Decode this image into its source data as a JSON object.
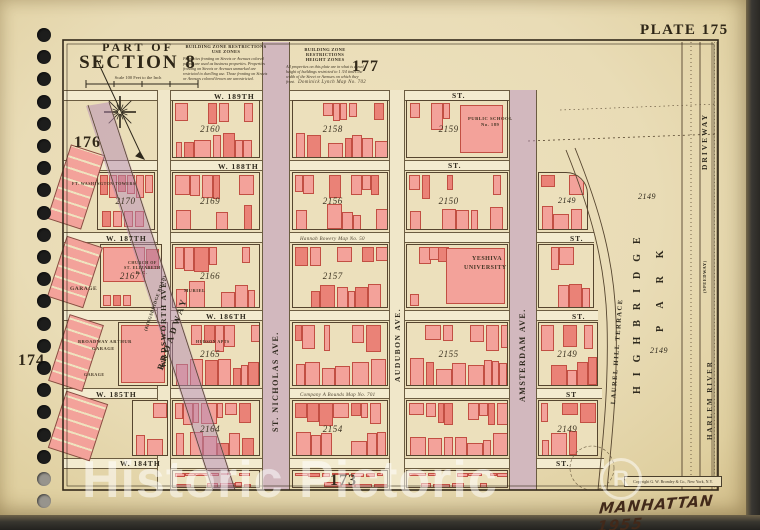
{
  "page": {
    "plate_label": "PLATE 175",
    "part_of": "PART OF",
    "section": "SECTION 8",
    "scale_note": "Scale 100 Feet to the Inch",
    "handwritten_note": "MANHATTAN 1955",
    "watermark_text": "Historic Pictoric",
    "watermark_mark": "R",
    "copyright": "Copyright G. W. Bromley & Co., New York, N.Y.",
    "adjacent_plates": {
      "top": "177",
      "upper_left": "176",
      "left": "174",
      "bottom": "173"
    }
  },
  "zone_restrictions": {
    "use": {
      "heading": "BUILDING ZONE RESTRICTIONS",
      "subheading": "USE ZONES",
      "body": "Properties fronting on Streets or Avenues colored purple are used as business properties. Properties fronting on Streets or Avenues unmarked are restricted to dwelling use. Those fronting on Streets or Avenues colored brown are unrestricted."
    },
    "height": {
      "heading": "BUILDING ZONE RESTRICTIONS",
      "subheading": "HEIGHT ZONES",
      "body": "All properties on this plate are in what is zoned height of buildings restricted to 1 3/4 times the width of the Street or Avenues on which they front."
    }
  },
  "colors": {
    "page": "#e9dcb6",
    "building": "#f3a29a",
    "building_outline": "#c24f43",
    "zone_purple": "#b48ab4",
    "line": "#56452f",
    "hole_dark": "#1d1d1c",
    "hole_light": "#97948d"
  },
  "map": {
    "street_labels": [
      {
        "t": "W. 189TH",
        "x": 214,
        "y": 92
      },
      {
        "t": "ST.",
        "x": 452,
        "y": 91
      },
      {
        "t": "W. 188TH",
        "x": 218,
        "y": 162
      },
      {
        "t": "ST.",
        "x": 448,
        "y": 161
      },
      {
        "t": "W. 187TH",
        "x": 106,
        "y": 234
      },
      {
        "t": "ST.",
        "x": 570,
        "y": 234
      },
      {
        "t": "W. 186TH",
        "x": 206,
        "y": 312
      },
      {
        "t": "ST.",
        "x": 572,
        "y": 312
      },
      {
        "t": "W. 185TH",
        "x": 96,
        "y": 390
      },
      {
        "t": "ST",
        "x": 566,
        "y": 390
      },
      {
        "t": "W. 184TH",
        "x": 120,
        "y": 459
      },
      {
        "t": "ST.",
        "x": 556,
        "y": 459
      }
    ],
    "avenue_labels": [
      {
        "t": "BROADWAY",
        "x": 155,
        "y": 368,
        "r": -71,
        "s": 9,
        "ls": 3
      },
      {
        "t": "(KINGSBRIDGE ROAD)",
        "x": 143,
        "y": 330,
        "r": -71,
        "s": 4.5,
        "ls": 0.5
      },
      {
        "t": "WADSWORTH AVE.",
        "x": 159,
        "y": 368,
        "r": -90,
        "s": 7.5,
        "ls": 1.5
      },
      {
        "t": "ST. NICHOLAS AVE.",
        "x": 271,
        "y": 432,
        "r": -90,
        "s": 8,
        "ls": 1.5
      },
      {
        "t": "AUDUBON AVE.",
        "x": 393,
        "y": 382,
        "r": -90,
        "s": 7.5,
        "ls": 1.5
      },
      {
        "t": "AMSTERDAM AVE.",
        "x": 518,
        "y": 402,
        "r": -90,
        "s": 8,
        "ls": 1.5
      },
      {
        "t": "LAUREL HILL TERRACE",
        "x": 610,
        "y": 404,
        "r": -86,
        "s": 6.5,
        "ls": 1.5
      },
      {
        "t": "DRIVEWAY",
        "x": 700,
        "y": 170,
        "r": -90,
        "s": 7.5,
        "ls": 2
      },
      {
        "t": "(SPEEDWAY)",
        "x": 702,
        "y": 293,
        "r": -90,
        "s": 4.5,
        "ls": 0.5
      },
      {
        "t": "HARLEM RIVER",
        "x": 706,
        "y": 440,
        "r": -90,
        "s": 7,
        "ls": 2
      },
      {
        "t": "HIGHBRIDGE",
        "x": 632,
        "y": 394,
        "r": -90,
        "s": 10,
        "ls": 10
      },
      {
        "t": "PARK",
        "x": 655,
        "y": 332,
        "r": -90,
        "s": 10,
        "ls": 18
      }
    ],
    "map_refs": [
      {
        "t": "Dominick Lynch Map No. 702",
        "x": 298,
        "y": 80
      },
      {
        "t": "Hannah Bowery Map No. 50",
        "x": 300,
        "y": 237
      },
      {
        "t": "Company A Bounds Map No. 701",
        "x": 300,
        "y": 393
      }
    ],
    "park_numbers": [
      {
        "t": "2149",
        "x": 638,
        "y": 192
      },
      {
        "t": "2149",
        "x": 650,
        "y": 346
      },
      {
        "t": "2149",
        "x": 558,
        "y": 196
      }
    ],
    "building_labels": [
      {
        "t": "FT. WASHINGTON TOWERS",
        "x": 72,
        "y": 181,
        "s": 4
      },
      {
        "t": "CHURCH OF",
        "x": 128,
        "y": 260,
        "s": 4
      },
      {
        "t": "ST. ELIZABETH",
        "x": 124,
        "y": 265,
        "s": 4
      },
      {
        "t": "R. C.",
        "x": 136,
        "y": 270,
        "s": 4
      },
      {
        "t": "GARAGE",
        "x": 70,
        "y": 286,
        "s": 5.5
      },
      {
        "t": "BROADWAY ARTHUR",
        "x": 78,
        "y": 339,
        "s": 4.5
      },
      {
        "t": "GARAGE",
        "x": 92,
        "y": 346,
        "s": 4.5
      },
      {
        "t": "GARAGE",
        "x": 84,
        "y": 372,
        "s": 4
      },
      {
        "t": "MURIEL",
        "x": 184,
        "y": 288,
        "s": 4.5
      },
      {
        "t": "HUDSON APTS",
        "x": 196,
        "y": 339,
        "s": 4
      },
      {
        "t": "PUBLIC SCHOOL",
        "x": 468,
        "y": 116,
        "s": 4.6
      },
      {
        "t": "No. 189",
        "x": 481,
        "y": 122,
        "s": 4.6
      },
      {
        "t": "YESHIVA",
        "x": 472,
        "y": 256,
        "s": 6
      },
      {
        "t": "UNIVERSITY",
        "x": 464,
        "y": 265,
        "s": 6
      }
    ],
    "blocks": [
      {
        "n": "2160",
        "x": 172,
        "y": 100,
        "w": 88,
        "h": 58
      },
      {
        "n": "2158",
        "x": 292,
        "y": 100,
        "w": 96,
        "h": 58
      },
      {
        "n": "2159",
        "x": 406,
        "y": 100,
        "w": 102,
        "h": 58,
        "s": "school"
      },
      {
        "n": "2170",
        "x": 97,
        "y": 172,
        "w": 58,
        "h": 58,
        "s": "rows"
      },
      {
        "n": "2169",
        "x": 172,
        "y": 172,
        "w": 88,
        "h": 58
      },
      {
        "n": "2156",
        "x": 292,
        "y": 172,
        "w": 96,
        "h": 58
      },
      {
        "n": "2150",
        "x": 406,
        "y": 172,
        "w": 102,
        "h": 58
      },
      {
        "n": "",
        "x": 538,
        "y": 172,
        "w": 50,
        "h": 58,
        "s": "rTR"
      },
      {
        "n": "2167",
        "x": 100,
        "y": 244,
        "w": 62,
        "h": 64,
        "s": "church"
      },
      {
        "n": "2166",
        "x": 172,
        "y": 244,
        "w": 88,
        "h": 64
      },
      {
        "n": "2157",
        "x": 292,
        "y": 244,
        "w": 96,
        "h": 64
      },
      {
        "n": "",
        "x": 406,
        "y": 244,
        "w": 102,
        "h": 64,
        "s": "yeshiva"
      },
      {
        "n": "",
        "x": 538,
        "y": 244,
        "w": 56,
        "h": 64
      },
      {
        "n": "",
        "x": 118,
        "y": 322,
        "w": 50,
        "h": 64,
        "s": "solid"
      },
      {
        "n": "2165",
        "x": 172,
        "y": 322,
        "w": 88,
        "h": 64
      },
      {
        "n": "",
        "x": 292,
        "y": 322,
        "w": 96,
        "h": 64
      },
      {
        "n": "2155",
        "x": 406,
        "y": 322,
        "w": 102,
        "h": 64
      },
      {
        "n": "2149",
        "x": 538,
        "y": 322,
        "w": 60,
        "h": 64
      },
      {
        "n": "",
        "x": 132,
        "y": 400,
        "w": 36,
        "h": 56
      },
      {
        "n": "2164",
        "x": 172,
        "y": 400,
        "w": 88,
        "h": 56
      },
      {
        "n": "2154",
        "x": 292,
        "y": 400,
        "w": 96,
        "h": 56
      },
      {
        "n": "",
        "x": 406,
        "y": 400,
        "w": 102,
        "h": 56
      },
      {
        "n": "2149",
        "x": 538,
        "y": 400,
        "w": 60,
        "h": 56
      },
      {
        "n": "",
        "x": 172,
        "y": 470,
        "w": 88,
        "h": 18
      },
      {
        "n": "",
        "x": 292,
        "y": 470,
        "w": 96,
        "h": 18
      },
      {
        "n": "",
        "x": 406,
        "y": 470,
        "w": 102,
        "h": 18
      }
    ],
    "west_strips": [
      {
        "x": 58,
        "y": 148,
        "w": 34,
        "h": 76,
        "r": 18
      },
      {
        "x": 56,
        "y": 240,
        "w": 36,
        "h": 62,
        "r": 18
      },
      {
        "x": 58,
        "y": 318,
        "w": 34,
        "h": 68,
        "r": 18
      },
      {
        "x": 56,
        "y": 396,
        "w": 42,
        "h": 58,
        "r": 18
      }
    ],
    "street_bands": [
      {
        "x": 64,
        "y": 90,
        "w": 446,
        "h": 11
      },
      {
        "x": 64,
        "y": 160,
        "w": 472,
        "h": 11
      },
      {
        "x": 64,
        "y": 232,
        "w": 530,
        "h": 11
      },
      {
        "x": 64,
        "y": 310,
        "w": 534,
        "h": 11
      },
      {
        "x": 64,
        "y": 388,
        "w": 538,
        "h": 11
      },
      {
        "x": 64,
        "y": 458,
        "w": 540,
        "h": 11
      }
    ],
    "avenue_bands": [
      {
        "x": 157,
        "y": 90,
        "w": 14,
        "h": 400
      },
      {
        "x": 262,
        "y": 42,
        "w": 28,
        "h": 448
      },
      {
        "x": 389,
        "y": 90,
        "w": 16,
        "h": 400
      },
      {
        "x": 509,
        "y": 90,
        "w": 28,
        "h": 400
      }
    ]
  }
}
